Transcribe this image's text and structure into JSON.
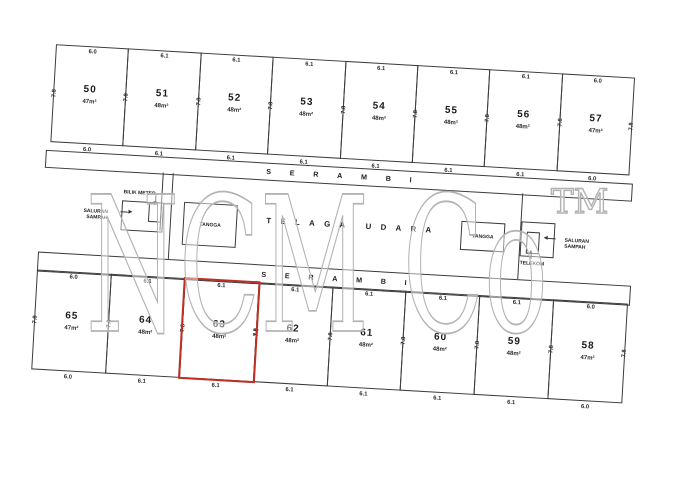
{
  "watermark": {
    "text": "NCM Co",
    "tm": "TM",
    "stroke_color": "#b3b3b3"
  },
  "colors": {
    "line": "#3c3c3c",
    "highlight": "#be3024"
  },
  "corridor_top": {
    "label": "SERAMBI"
  },
  "corridor_bottom": {
    "label": "SERAMBI"
  },
  "air_well": {
    "label": "TELAGA UDARA"
  },
  "facilities": {
    "bilik_meter": "BILIK METER",
    "saluran_sampah_left_line1": "SALURAN",
    "saluran_sampah_left_line2": "SAMPAH",
    "tangga_left": "TANGGA",
    "tangga_right": "TANGGA",
    "saluran_sampah_right_line1": "SALURAN",
    "saluran_sampah_right_line2": "SAMPAH",
    "telekom": "TELEKOM"
  },
  "top_row": [
    {
      "num": "50",
      "area": "47m²",
      "top": "6.0",
      "bottom": "6.0",
      "side": "7.8"
    },
    {
      "num": "51",
      "area": "48m²",
      "top": "6.1",
      "bottom": "6.1",
      "side": "7.8"
    },
    {
      "num": "52",
      "area": "48m²",
      "top": "6.1",
      "bottom": "6.1",
      "side": "7.8"
    },
    {
      "num": "53",
      "area": "48m²",
      "top": "6.1",
      "bottom": "6.1",
      "side": "7.8"
    },
    {
      "num": "54",
      "area": "48m²",
      "top": "6.1",
      "bottom": "6.1",
      "side": "7.8"
    },
    {
      "num": "55",
      "area": "48m²",
      "top": "6.1",
      "bottom": "6.1",
      "side": "7.8"
    },
    {
      "num": "56",
      "area": "48m²",
      "top": "6.1",
      "bottom": "6.1",
      "side": "7.8"
    },
    {
      "num": "57",
      "area": "47m²",
      "top": "6.0",
      "bottom": "6.0",
      "side": "7.8",
      "side_right": "7.8"
    }
  ],
  "bottom_row": [
    {
      "num": "65",
      "area": "47m²",
      "top": "6.0",
      "bottom": "6.0",
      "side": "7.8"
    },
    {
      "num": "64",
      "area": "48m²",
      "top": "6.1",
      "bottom": "6.1",
      "side": "7.8"
    },
    {
      "num": "63",
      "area": "48m²",
      "top": "6.1",
      "bottom": "6.1",
      "side": "7.8",
      "side_right": "7.8",
      "highlighted": true
    },
    {
      "num": "62",
      "area": "48m²",
      "top": "6.1",
      "bottom": "6.1",
      "side": "7.8"
    },
    {
      "num": "61",
      "area": "48m²",
      "top": "6.1",
      "bottom": "6.1",
      "side": "7.8"
    },
    {
      "num": "60",
      "area": "48m²",
      "top": "6.1",
      "bottom": "6.1",
      "side": "7.8"
    },
    {
      "num": "59",
      "area": "48m²",
      "top": "6.1",
      "bottom": "6.1",
      "side": "7.8"
    },
    {
      "num": "58",
      "area": "47m²",
      "top": "6.0",
      "bottom": "6.0",
      "side": "7.8",
      "side_right": "7.8"
    }
  ]
}
